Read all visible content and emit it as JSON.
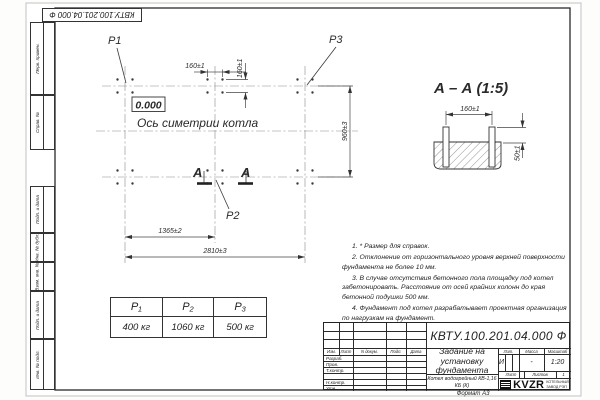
{
  "sheet": {
    "stamp_top": "КВТУ.100.201.04.000  Ф",
    "format_label": "Формат А3",
    "sidebar_labels": [
      "Перв. примен.",
      "Справ. №",
      "Подп. и дата",
      "Инв. № дубл.",
      "Взам. инв. №",
      "Подп. и дата",
      "Инв. № подл."
    ]
  },
  "plan": {
    "point_p1": "P1",
    "point_p2": "P2",
    "point_p3": "P3",
    "elevation": "0.000",
    "axis_label": "Ось симетрии котла",
    "dim_160_top": "160±1",
    "dim_160_side": "160±1",
    "dim_960": "960±3",
    "dim_1365": "1365±2",
    "dim_2810": "2810±3",
    "section_letter": "А"
  },
  "section": {
    "title": "А – А (1:5)",
    "dim_160": "160±1",
    "dim_50": "50±1"
  },
  "notes": {
    "items": [
      "1. * Размер для справок.",
      "2. Отклонение от горизонтального уровня верхней поверхности фундамента не более 10 мм.",
      "3. В случае отсутствия бетонного пола площадку под котел забетонировать. Расстояние от осей крайних колонн до края бетонной подушки 500 мм.",
      "4. Фундамент под котел разрабатывает проектная организация по нагрузкам на фундамент."
    ]
  },
  "load_table": {
    "headers": [
      "P₁",
      "P₂",
      "P₃"
    ],
    "values": [
      "400 кг",
      "1060 кг",
      "500 кг"
    ]
  },
  "title_block": {
    "designation": "КВТУ.100.201.04.000  Ф",
    "doc_title": "Задание на установку фундамента",
    "product": "Котел водогрейный КВ-1,16 КБ (К)",
    "col_izm": "Изм.",
    "col_list": "Лист",
    "col_doc": "N докум.",
    "col_sign": "Подп.",
    "col_date": "Дата",
    "row_developed": "Разраб.",
    "row_checked": "Пров.",
    "row_tcontrol": "Т.контр.",
    "row_ncontrol": "Н.контр.",
    "row_approved": "Утв.",
    "lit_label": "Лит.",
    "mass_label": "Масса",
    "scale_label": "Масштаб",
    "lit_value": "И",
    "mass_value": "-",
    "scale_value": "1:20",
    "sheet_label": "Лист",
    "sheets_label": "Листов",
    "sheets_value": "1",
    "company": "KVZR",
    "company_line1": "КОТЕЛЬНЫЙ",
    "company_line2": "ЗАВОД РЭП"
  }
}
